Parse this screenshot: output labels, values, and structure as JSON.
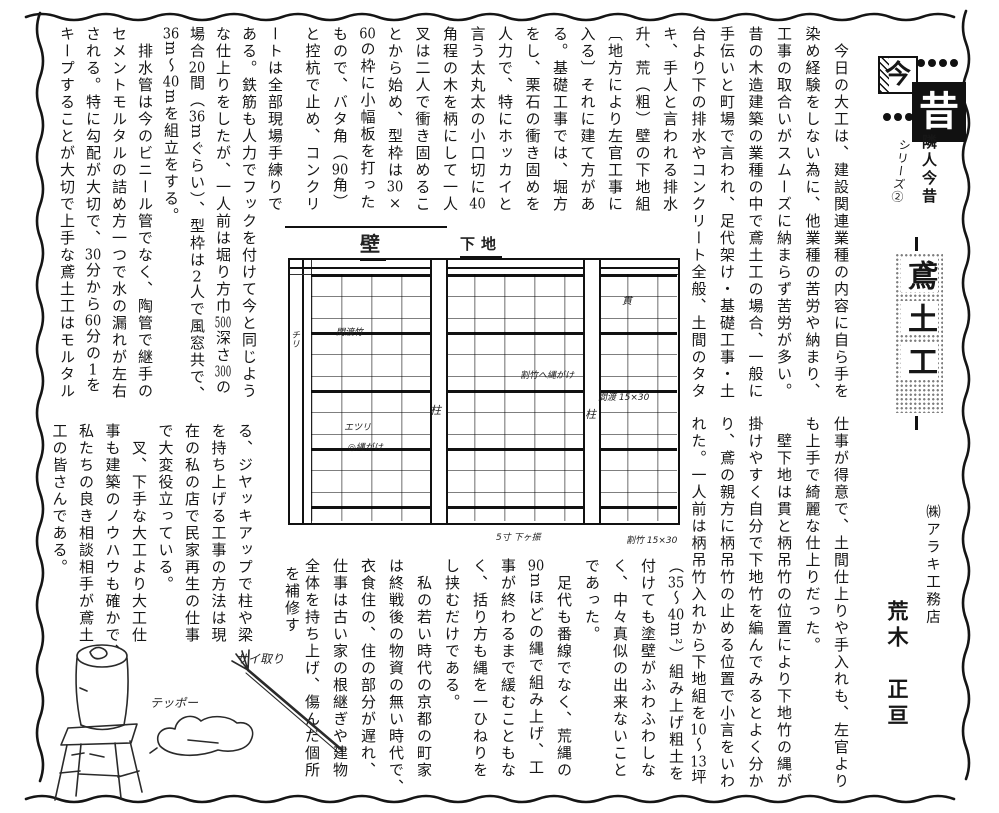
{
  "page": {
    "background": "#ffffff",
    "ink": "#161616"
  },
  "header": {
    "badge_now": "今",
    "badge_past": "昔",
    "series_title": "隣人今昔",
    "series_no": "シリーズ②"
  },
  "title": {
    "text": "鳶土工",
    "chars": [
      "鳶",
      "土",
      "工"
    ]
  },
  "byline": {
    "company": "㈱アラキ工務店",
    "name": "荒木　正亘"
  },
  "article": {
    "a1": [
      "　今日の大工は、建設関連業種の内容に自ら手を",
      "染め経験をしない為に、他業種の苦労や納まり、",
      "工事の取合いがスムーズに納まらず苦労が多い。",
      "昔の木造建築の業種の中で鳶土工の場合、一般に",
      "手伝いと町場で言われ、足代架け・基礎工事・土",
      "台より下の排水やコンクリート全般、土間のタタ"
    ],
    "a2": [
      "キ、手人と言われる排水",
      "升、荒（粗）壁の下地組",
      "〔地方により左官工事に",
      "入る〕それに建て方があ",
      "る。基礎工事では、堀方",
      "をし、栗石の衝き固めを",
      "人力で、特にホッカイと",
      "言う太丸太の小口切に40",
      "角程の木を柄にして一人",
      "叉は二人で衝き固めるこ",
      "とから始め、型枠は30×",
      "60の枠に小幅板を打った",
      "もので、バタ角（90角）",
      "と控杭で止め、コンクリ"
    ],
    "a3": [
      "ートは全部現場手練りで",
      "ある。鉄筋も人力でフックを付けて今と同じよう",
      "な仕上りをしたが、一人前は堀り方巾500深さ300の",
      "場合20間（36mぐらい）、型枠は2人で風窓共で、",
      "36m〜40mを組立をする。",
      "　排水管は今のビニール管でなく、陶管で継手の",
      "セメントモルタルの詰め方一つで水の漏れが左右",
      "される。特に勾配が大切で、30分から60分の1を",
      "キープすることが大切で上手な鳶土工はモルタル"
    ],
    "b": [
      "仕事が得意で、土間仕上りや手入れも、左官より",
      "も上手で綺麗な仕上りだった。",
      "　壁下地は貫と柄吊竹の位置により下地竹の縄が",
      "掛けやすく自分で下地竹を編んでみるとよく分か",
      "り、鳶の親方に柄吊竹の止める位置で小言をいわ",
      "れた。一人前は柄吊竹入れから下地組を10〜13坪"
    ],
    "c": [
      "（35〜40m²）組み上げ粗土を",
      "付けても塗壁がふわふわしな",
      "く、中々真似の出来ないこと",
      "であった。",
      "　足代も番線でなく、荒縄の",
      "90mほどの縄で組み上げ、工",
      "事が終わるまで緩むこともな",
      "く、括り方も縄を一ひねりを",
      "し挟むだけである。",
      "　私の若い時代の京都の町家",
      "は終戦後の物資の無い時代で、",
      "衣食住の、住の部分が遅れ、",
      "仕事は古い家の根継ぎや建物",
      "全体を持ち上げ、傷んだ個所"
    ],
    "d_hang": "を補修す",
    "d": [
      "る、ジヤッキアップで柱や梁",
      "を持ち上げる工事の方法は現",
      "在の私の店で民家再生の仕事",
      "で大変役立っている。",
      "　叉、下手な大工より大工仕",
      "事も建築のノウハウも確かで、",
      "私たちの良き相談相手が鳶土",
      "工の皆さんである。"
    ]
  },
  "diagram": {
    "annotations": [
      {
        "t": "壁",
        "x": 360,
        "y": 228,
        "fs": 20,
        "ul": true
      },
      {
        "t": "下地",
        "x": 460,
        "y": 233,
        "fs": 15,
        "ul": true
      },
      {
        "t": "チリ",
        "x": 288,
        "y": 330,
        "fs": 9,
        "v": true
      },
      {
        "t": "間渡竹",
        "x": 336,
        "y": 325,
        "fs": 9
      },
      {
        "t": "エツリ",
        "x": 344,
        "y": 420,
        "fs": 9
      },
      {
        "t": "◎縄がけ",
        "x": 348,
        "y": 440,
        "fs": 9
      },
      {
        "t": "柱",
        "x": 430,
        "y": 402,
        "fs": 11
      },
      {
        "t": "柱",
        "x": 585,
        "y": 406,
        "fs": 11
      },
      {
        "t": "貫",
        "x": 622,
        "y": 292,
        "fs": 10
      },
      {
        "t": "間渡 15×30",
        "x": 598,
        "y": 390,
        "fs": 9
      },
      {
        "t": "割竹へ縄がけ",
        "x": 520,
        "y": 368,
        "fs": 9
      },
      {
        "t": "5寸 下ヶ振",
        "x": 496,
        "y": 530,
        "fs": 9
      },
      {
        "t": "割竹 15×30",
        "x": 626,
        "y": 533,
        "fs": 9
      }
    ]
  },
  "tools": {
    "labels": [
      {
        "t": "テッポー",
        "x": 150,
        "y": 694,
        "fs": 12
      },
      {
        "t": "サイ取り",
        "x": 236,
        "y": 650,
        "fs": 12
      }
    ]
  }
}
